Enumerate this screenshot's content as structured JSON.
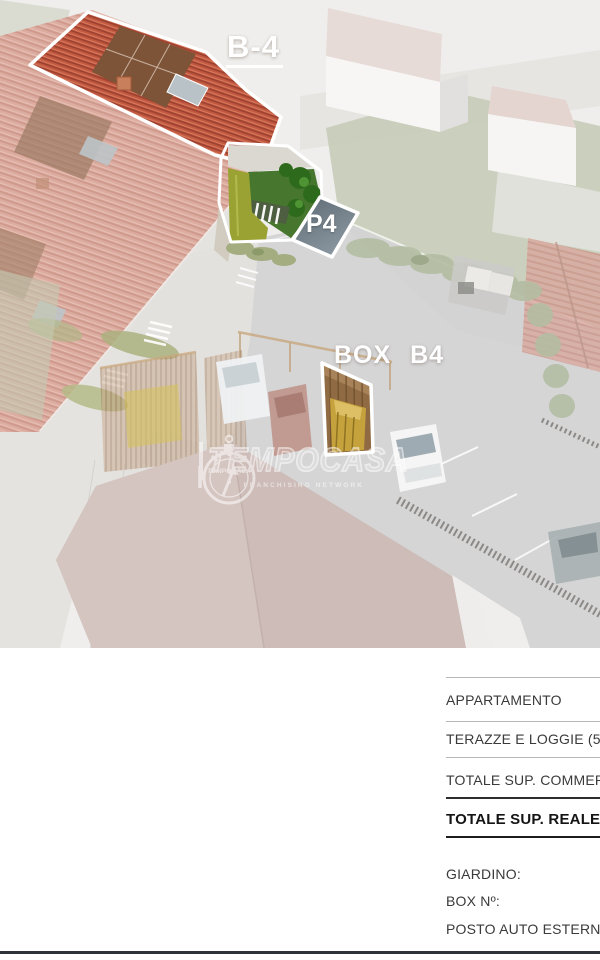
{
  "render": {
    "labels": {
      "unit": "B-4",
      "parking_spot": "P4",
      "garage_box": "BOX B4"
    },
    "watermark": {
      "brand": "TEMPOCASA",
      "badge_brand": "TEMPOCASA",
      "tagline": "FRANCHISING NETWORK"
    },
    "colors": {
      "highlight_roof": "#c25a41",
      "faded_roof": "#dcaca0",
      "solar_panel": "#7e5438",
      "garden_green": "#47762f",
      "parking_fill": "#6a7780",
      "outline": "#ffffff"
    }
  },
  "specs": {
    "rows": {
      "apartment": "APPARTAMENTO",
      "terraces": "TERAZZE E LOGGIE (50%",
      "total_commercial": "TOTALE SUP. COMMERCIALE",
      "total_real": "TOTALE SUP. REALE",
      "garden": "GIARDINO:",
      "box_number": "BOX Nº:",
      "outdoor_parking": "POSTO AUTO ESTERNO"
    }
  }
}
